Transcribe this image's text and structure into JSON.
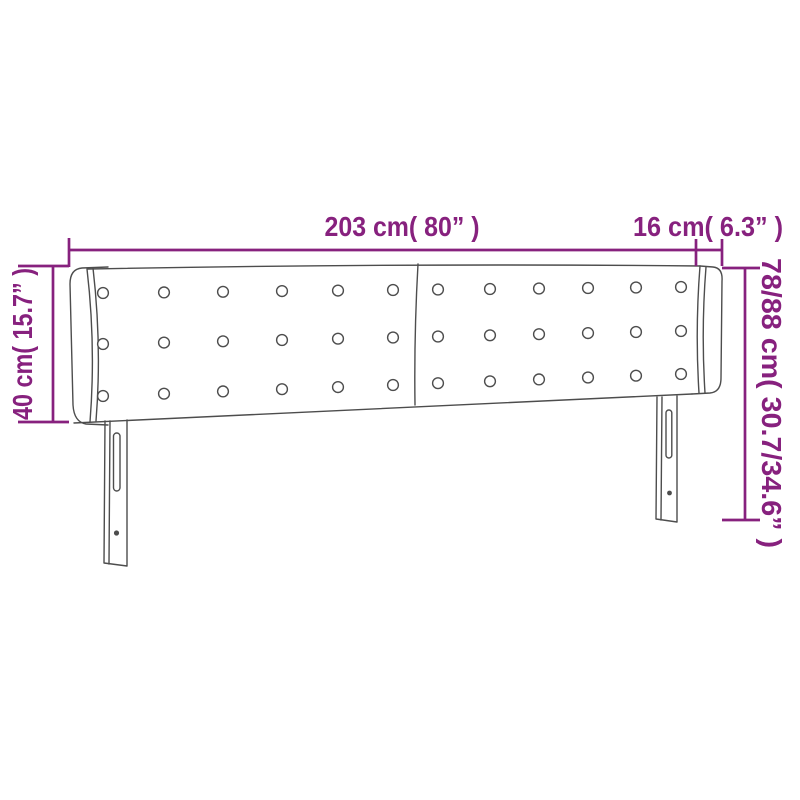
{
  "colors": {
    "accent": "#87217E",
    "line": "#4D4D4D",
    "background": "#FFFFFF"
  },
  "dimensions": {
    "width": {
      "label": "203 cm( 80” )",
      "cm": "203",
      "inches": "80"
    },
    "side_depth": {
      "label": "16 cm( 6.3” )",
      "cm": "16",
      "inches": "6.3"
    },
    "side_height": {
      "label": "40 cm( 15.7” )",
      "cm": "40",
      "inches": "15.7"
    },
    "total_height": {
      "label": "78/88 cm( 30.7/34.6” )",
      "cm": "78/88",
      "inches": "30.7/34.6"
    }
  }
}
